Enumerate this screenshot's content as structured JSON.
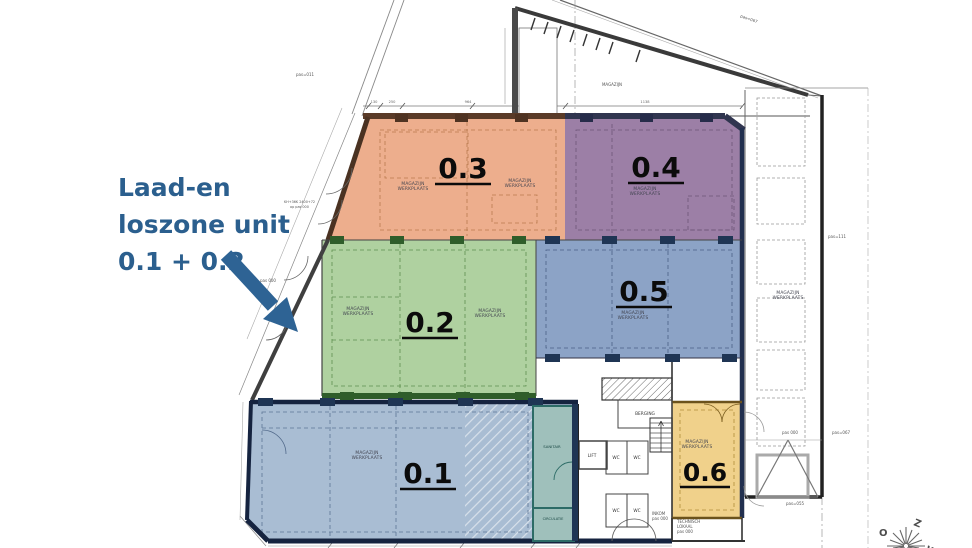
{
  "callout": {
    "line1": "Laad-en",
    "line2": "loszone unit",
    "line3": "0.1 + 0.2"
  },
  "zones": [
    {
      "id": "0.1",
      "color": "#a9bdd3"
    },
    {
      "id": "0.2",
      "color": "#afd1a0"
    },
    {
      "id": "0.3",
      "color": "#edae8d"
    },
    {
      "id": "0.4",
      "color": "#9c7fa6"
    },
    {
      "id": "0.5",
      "color": "#8ca3c6"
    },
    {
      "id": "0.6",
      "color": "#f0d18b"
    }
  ],
  "labels": {
    "magazijn": "MAGAZIJN",
    "mw1": "MAGAZIJN",
    "mw2": "WERKPLAATS",
    "berging": "BERGING",
    "lift": "LIFT",
    "wc": "WC",
    "inkom": "INKOM",
    "inkom_pas": "pas 000",
    "technisch1": "TECHNISCH",
    "technisch2": "LOKAAL",
    "technisch_pas": "pas 000",
    "sanitair": "SANITAIR",
    "circulatie": "CIRCULATIE"
  },
  "site": {
    "pas067_top": "pas=067",
    "pas011": "pas=011",
    "kh_note1": "KH+36K 2400+72",
    "kh_note2": "op pas 000",
    "pas000_left": "pas 000",
    "pas111": "pas=111",
    "pas000_right": "pas 000",
    "pas067_right": "pas=067",
    "pas055": "pas=055"
  },
  "dimensions": {
    "d130": "130",
    "d250": "250",
    "d964": "964",
    "d1138": "1138"
  },
  "compass": {
    "z": "Z",
    "o": "O",
    "w": "W"
  }
}
